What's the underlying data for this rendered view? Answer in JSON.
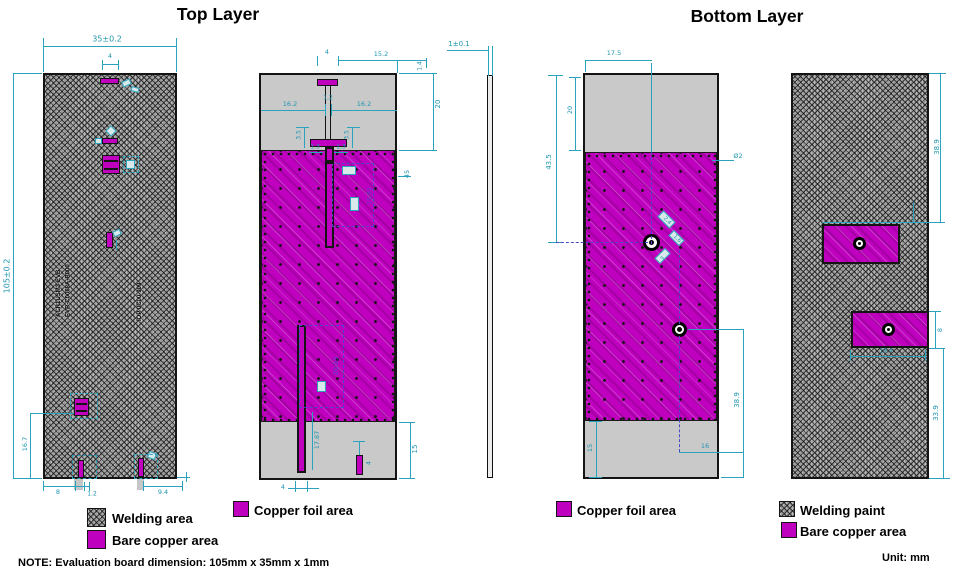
{
  "titles": {
    "top": "Top Layer",
    "bottom": "Bottom Layer"
  },
  "note": "NOTE: Evaluation board dimension: 105mm x 35mm x 1mm",
  "unit": "Unit: mm",
  "legend": {
    "welding_area": "Welding area",
    "bare_copper": "Bare copper area",
    "copper_foil_left": "Copper foil area",
    "copper_foil_right": "Copper foil area",
    "welding_paint": "Welding paint",
    "bare_copper2": "Bare copper area"
  },
  "silkscreen": {
    "line1": "ACR1USM3-EVB",
    "line2": "EVB-C0068A-B000",
    "line3": "IOP 0C00-909"
  },
  "colors": {
    "copper": "#BF00BF",
    "dimension_cyan": "#1E96AF",
    "annotation_blue": "#4A4AC8"
  },
  "dim_labels": [
    {
      "text": "35±0.2",
      "x": 107,
      "y": 39,
      "rot": 0,
      "size": 8
    },
    {
      "text": "105±0.2",
      "x": 7,
      "y": 276,
      "rot": -90,
      "size": 8
    },
    {
      "text": "4",
      "x": 110,
      "y": 56,
      "rot": 0,
      "size": 6.5
    },
    {
      "text": "16.7",
      "x": 25,
      "y": 444,
      "rot": -90,
      "size": 6.5
    },
    {
      "text": "8",
      "x": 58,
      "y": 492,
      "rot": 0,
      "size": 6.5
    },
    {
      "text": "1.2",
      "x": 92,
      "y": 494,
      "rot": 0,
      "size": 6
    },
    {
      "text": "9.4",
      "x": 163,
      "y": 492,
      "rot": 0,
      "size": 6.5
    },
    {
      "text": "15.2",
      "x": 381,
      "y": 54,
      "rot": 0,
      "size": 6.5
    },
    {
      "text": "1.4",
      "x": 420,
      "y": 66,
      "rot": -90,
      "size": 6
    },
    {
      "text": "4",
      "x": 327,
      "y": 52,
      "rot": 0,
      "size": 6.5
    },
    {
      "text": "16.2",
      "x": 290,
      "y": 104,
      "rot": 0,
      "size": 6.5
    },
    {
      "text": "1.2",
      "x": 328,
      "y": 98,
      "rot": 0,
      "size": 6
    },
    {
      "text": "16.2",
      "x": 364,
      "y": 104,
      "rot": 0,
      "size": 6.5
    },
    {
      "text": "20",
      "x": 438,
      "y": 104,
      "rot": -90,
      "size": 7
    },
    {
      "text": "3.5",
      "x": 299,
      "y": 135,
      "rot": -90,
      "size": 6
    },
    {
      "text": "3.5",
      "x": 347,
      "y": 135,
      "rot": -90,
      "size": 6
    },
    {
      "text": "1.3",
      "x": 315,
      "y": 147,
      "rot": 0,
      "size": 6
    },
    {
      "text": "1.3",
      "x": 341,
      "y": 147,
      "rot": 0,
      "size": 6
    },
    {
      "text": "45",
      "x": 407,
      "y": 174,
      "rot": -90,
      "size": 6.5
    },
    {
      "text": "15.93",
      "x": 370,
      "y": 196,
      "rot": -90,
      "size": 6,
      "color": "blue"
    },
    {
      "text": "20.93",
      "x": 336,
      "y": 366,
      "rot": -90,
      "size": 6.5,
      "color": "blue"
    },
    {
      "text": "17.87",
      "x": 317,
      "y": 440,
      "rot": -90,
      "size": 6.5
    },
    {
      "text": "15",
      "x": 415,
      "y": 449,
      "rot": -90,
      "size": 7
    },
    {
      "text": "4",
      "x": 369,
      "y": 463,
      "rot": -90,
      "size": 6
    },
    {
      "text": "4",
      "x": 283,
      "y": 487,
      "rot": 0,
      "size": 6.5
    },
    {
      "text": "1±0.1",
      "x": 459,
      "y": 44,
      "rot": 0,
      "size": 7
    },
    {
      "text": "17.5",
      "x": 614,
      "y": 53,
      "rot": 0,
      "size": 6.5
    },
    {
      "text": "20",
      "x": 570,
      "y": 110,
      "rot": -90,
      "size": 6.5
    },
    {
      "text": "43.5",
      "x": 549,
      "y": 162,
      "rot": -90,
      "size": 7
    },
    {
      "text": "38.9",
      "x": 737,
      "y": 400,
      "rot": -90,
      "size": 7
    },
    {
      "text": "16",
      "x": 705,
      "y": 446,
      "rot": 0,
      "size": 6.5
    },
    {
      "text": "15",
      "x": 590,
      "y": 448,
      "rot": -90,
      "size": 6.5
    },
    {
      "text": "Ø2",
      "x": 738,
      "y": 156,
      "rot": 0,
      "size": 6.5
    },
    {
      "text": "2.4",
      "x": 667,
      "y": 221,
      "rot": 45,
      "size": 5.5
    },
    {
      "text": "1.6",
      "x": 677,
      "y": 239,
      "rot": 45,
      "size": 5.5
    },
    {
      "text": "3",
      "x": 663,
      "y": 259,
      "rot": -45,
      "size": 5.5
    },
    {
      "text": "38.9",
      "x": 937,
      "y": 147,
      "rot": -90,
      "size": 7
    },
    {
      "text": "19.4",
      "x": 886,
      "y": 351,
      "rot": 0,
      "size": 6
    },
    {
      "text": "8",
      "x": 940,
      "y": 330,
      "rot": -90,
      "size": 6.5
    },
    {
      "text": "33.9",
      "x": 936,
      "y": 413,
      "rot": -90,
      "size": 7
    }
  ]
}
